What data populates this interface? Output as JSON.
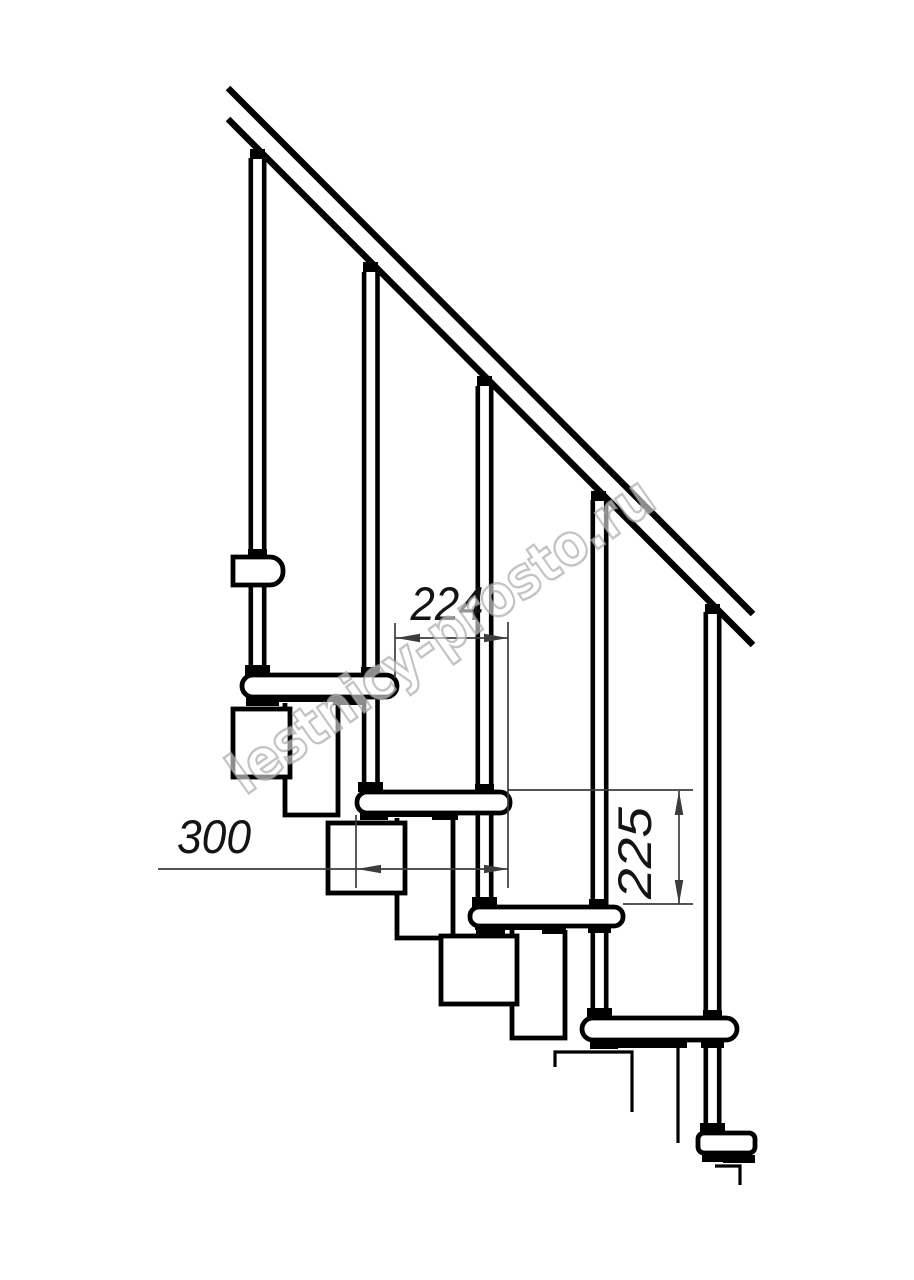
{
  "title": "Modular staircase technical drawing",
  "watermark": {
    "text": "lestnicy-prosto.ru"
  },
  "dimensions": {
    "step_run": "224",
    "tread_depth": "300",
    "riser_height": "225"
  },
  "colors": {
    "background": "#ffffff",
    "line": "#000000",
    "dim_line": "#3c3c3c",
    "watermark_stroke": "#a3a3a3",
    "watermark_fill": "#ffffff"
  },
  "geometry": {
    "rail_lines": [
      [
        228,
        88,
        753,
        614
      ],
      [
        228,
        119,
        753,
        645
      ]
    ],
    "rail_stroke": 6.5,
    "balusters": [
      {
        "cx": 257.5,
        "y1": 158,
        "y2": 675
      },
      {
        "cx": 370.8,
        "y1": 272,
        "y2": 792
      },
      {
        "cx": 484.5,
        "y1": 386,
        "y2": 907
      },
      {
        "cx": 599.5,
        "y1": 500,
        "y2": 1018
      },
      {
        "cx": 712.5,
        "y1": 612,
        "y2": 1133
      }
    ],
    "baluster_halfspan": 6.7,
    "baluster_stroke": 4.6,
    "columns": [
      [
        285,
        703,
        53,
        112
      ],
      [
        397,
        818,
        56,
        120
      ],
      [
        512,
        930,
        53,
        108
      ]
    ],
    "boxes": [
      [
        233,
        709,
        57,
        68
      ],
      [
        328,
        823,
        77,
        70
      ],
      [
        441,
        936,
        76,
        68
      ]
    ],
    "open_paths": [
      "M555,1067 L555,1052 L632,1052 L632,1112",
      "M678,1047 L678,1143",
      "M715,1166 L740,1166 L740,1185"
    ],
    "tread_first": "M233,557 L270,557 A13,13 0 0 1 283,570 L283,572 A13,13 0 0 1 270,585 L233,585 Z",
    "treads": [
      [
        242,
        675,
        155,
        22,
        11
      ],
      [
        357,
        792,
        153,
        21,
        10
      ],
      [
        470,
        907,
        153,
        19,
        9
      ],
      [
        582,
        1018,
        155,
        22,
        11
      ],
      [
        698,
        1133,
        57,
        20,
        6
      ]
    ],
    "outline_stroke": 4.8,
    "black_bits": [
      [
        246,
        697,
        117,
        5
      ],
      [
        246,
        697,
        33,
        9
      ],
      [
        333,
        697,
        30,
        8
      ],
      [
        360,
        812,
        98,
        5
      ],
      [
        360,
        812,
        28,
        8
      ],
      [
        432,
        812,
        26,
        8
      ],
      [
        475,
        925,
        91,
        5
      ],
      [
        476,
        925,
        29,
        9
      ],
      [
        542,
        926,
        23,
        8
      ],
      [
        590,
        1040,
        28,
        9
      ],
      [
        615,
        1042,
        72,
        6
      ],
      [
        702,
        1153,
        33,
        9
      ],
      [
        723,
        1155,
        32,
        8
      ],
      [
        245,
        665,
        25,
        10
      ],
      [
        358,
        782,
        25,
        10
      ],
      [
        472,
        897,
        25,
        10
      ],
      [
        587,
        1008,
        25,
        10
      ],
      [
        700,
        1123,
        25,
        10
      ],
      [
        248,
        549,
        19,
        8
      ],
      [
        361,
        667,
        19,
        8
      ],
      [
        475,
        784,
        19,
        8
      ],
      [
        589,
        899,
        19,
        8
      ],
      [
        703,
        1010,
        19,
        8
      ],
      [
        588,
        925,
        23,
        8
      ],
      [
        701,
        1040,
        23,
        8
      ],
      [
        250,
        149,
        15,
        10
      ],
      [
        363,
        262,
        15,
        10
      ],
      [
        477,
        376,
        15,
        10
      ],
      [
        591,
        491,
        15,
        10
      ],
      [
        705,
        604,
        15,
        10
      ]
    ],
    "dims": [
      {
        "line": [
          395,
          638,
          508,
          638
        ],
        "arrows": [
          [
            396,
            638,
            180
          ],
          [
            508,
            638,
            0
          ]
        ],
        "exts": [
          [
            395,
            623,
            395,
            678
          ],
          [
            508,
            622,
            508,
            888
          ]
        ]
      },
      {
        "line": [
          158,
          869,
          508,
          869
        ],
        "arrows": [
          [
            357,
            869,
            180
          ],
          [
            508,
            869,
            0
          ]
        ],
        "exts": [
          [
            356,
            815,
            356,
            888
          ]
        ]
      },
      {
        "line": [
          679,
          791,
          679,
          904
        ],
        "arrows": [
          [
            679,
            791,
            -90
          ],
          [
            679,
            904,
            90
          ]
        ],
        "exts": [
          [
            508,
            790,
            693,
            790
          ],
          [
            623,
            904,
            693,
            904
          ]
        ]
      }
    ],
    "dim_stroke": 1.7,
    "arrow_shape": "M0,0 L-24,4.3 L-24,-4.3 Z"
  }
}
